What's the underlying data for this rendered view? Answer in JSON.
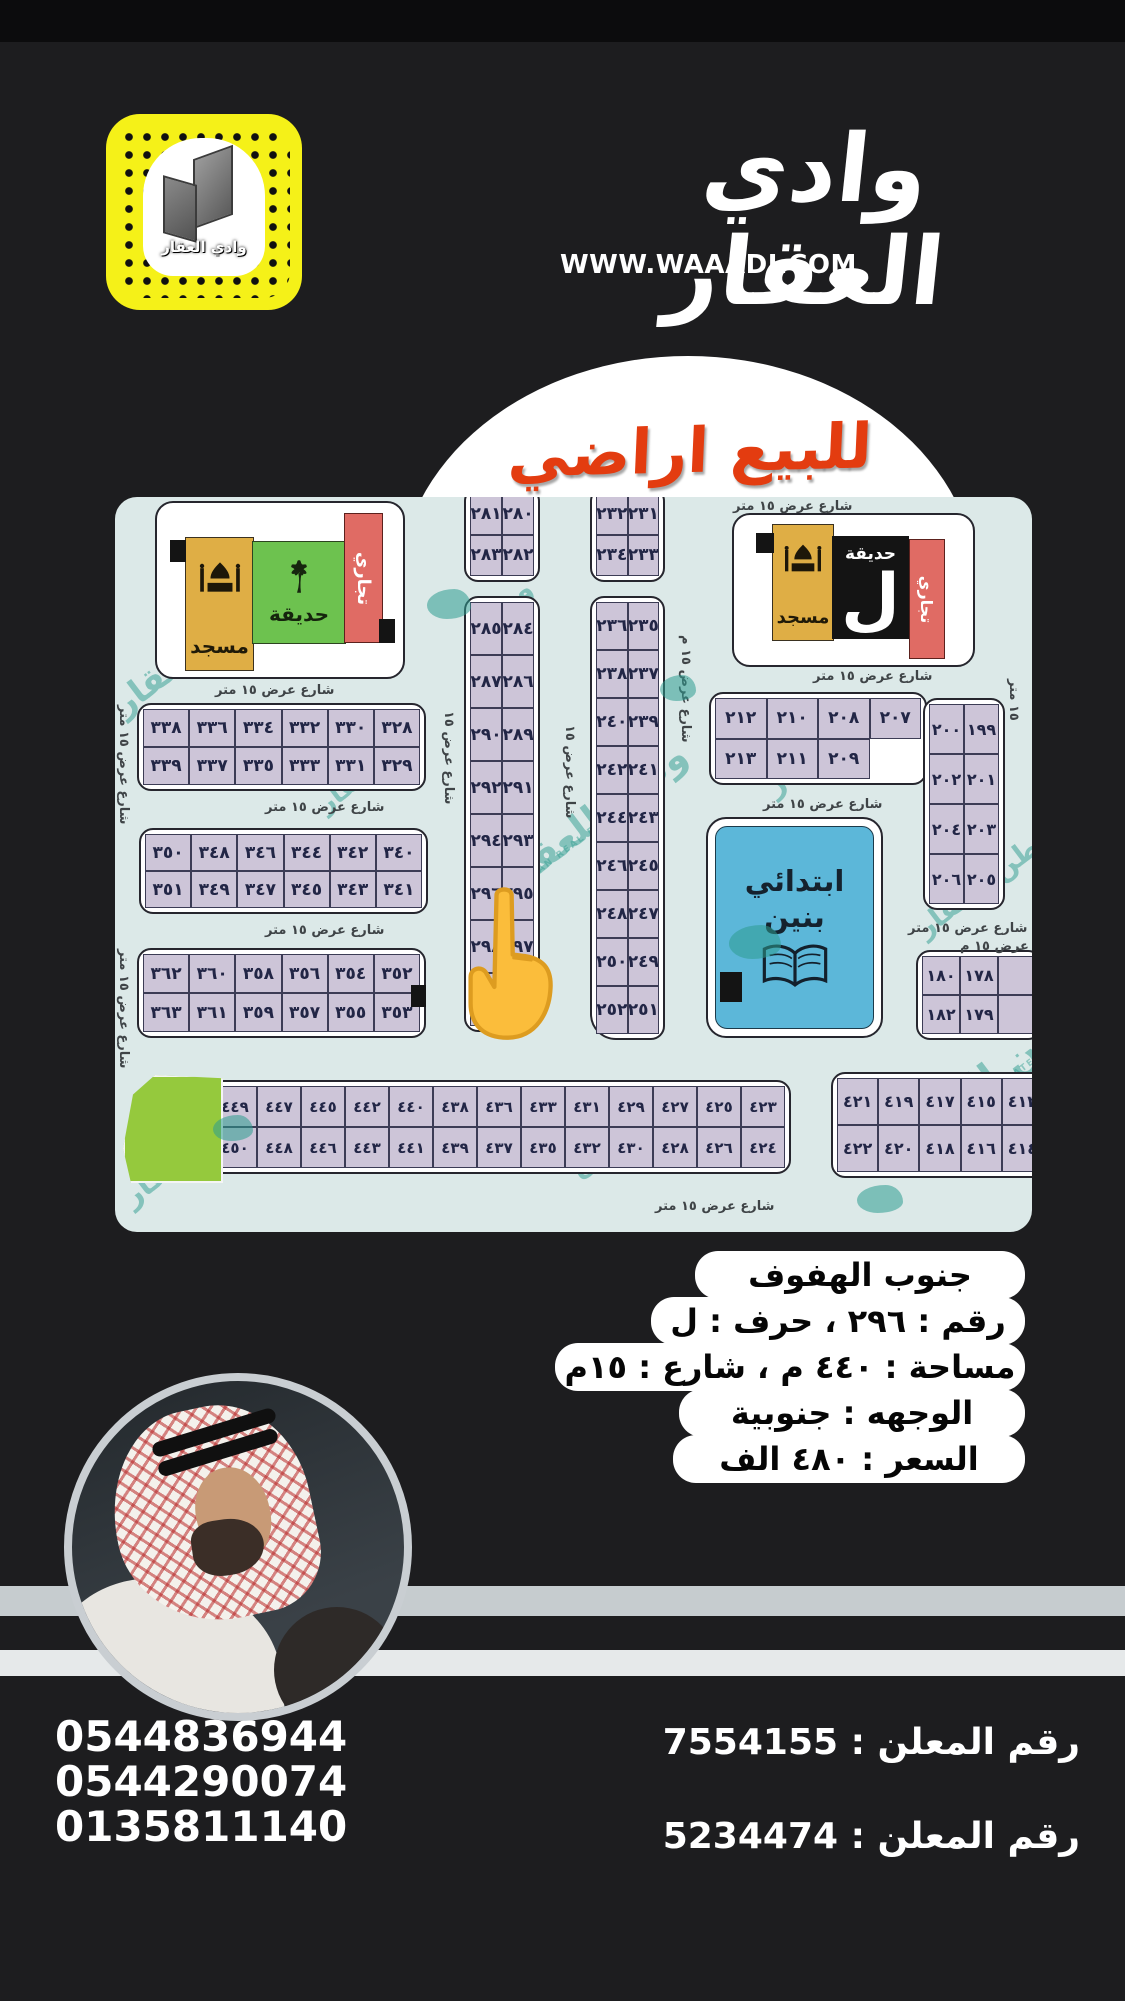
{
  "brand": {
    "name_ar": "وادي العقار",
    "website": "WWW.WAAADI.COM",
    "snapcode_caption": "وادي العقار"
  },
  "banner": {
    "title": "للبيع اراضي"
  },
  "map": {
    "facility": {
      "mosque": "مسجد",
      "garden": "حديقة",
      "commercial": "تجاري",
      "district_letter": "ل"
    },
    "school": {
      "line1": "ابتدائي",
      "line2": "بنين"
    },
    "plots": {
      "col_a_top": [
        [
          "٢٨١",
          "٢٨٠"
        ],
        [
          "٢٨٣",
          "٢٨٢"
        ]
      ],
      "col_a_main": [
        [
          "٢٨٥",
          "٢٨٤"
        ],
        [
          "٢٨٧",
          "٢٨٦"
        ],
        [
          "٢٩٠",
          "٢٨٩"
        ],
        [
          "٢٩٢",
          "٢٩١"
        ],
        [
          "٢٩٤",
          "٢٩٣"
        ],
        [
          "٢٩٦",
          "٢٩٥"
        ],
        [
          "٢٩٨",
          "٢٩٧"
        ],
        [
          "٣٠٠",
          "٢٩٩"
        ]
      ],
      "col_b_top": [
        [
          "٢٣٢",
          "٢٣١"
        ],
        [
          "٢٣٤",
          "٢٣٣"
        ]
      ],
      "col_b_main": [
        [
          "٢٣٦",
          "٢٣٥"
        ],
        [
          "٢٣٨",
          "٢٣٧"
        ],
        [
          "٢٤٠",
          "٢٣٩"
        ],
        [
          "٢٤٢",
          "٢٤١"
        ],
        [
          "٢٤٤",
          "٢٤٣"
        ],
        [
          "٢٤٦",
          "٢٤٥"
        ],
        [
          "٢٤٨",
          "٢٤٧"
        ],
        [
          "٢٥٠",
          "٢٤٩"
        ],
        [
          "٢٥٢",
          "٢٥١"
        ]
      ],
      "west_block_1": [
        [
          "٣٣٨",
          "٣٣٦",
          "٣٣٤",
          "٣٣٢",
          "٣٣٠",
          "٣٢٨"
        ],
        [
          "٣٣٩",
          "٣٣٧",
          "٣٣٥",
          "٣٣٣",
          "٣٣١",
          "٣٢٩"
        ]
      ],
      "west_block_2": [
        [
          "٣٥٠",
          "٣٤٨",
          "٣٤٦",
          "٣٤٤",
          "٣٤٢",
          "٣٤٠"
        ],
        [
          "٣٥١",
          "٣٤٩",
          "٣٤٧",
          "٣٤٥",
          "٣٤٣",
          "٣٤١"
        ]
      ],
      "west_block_3": [
        [
          "٣٦٢",
          "٣٦٠",
          "٣٥٨",
          "٣٥٦",
          "٣٥٤",
          "٣٥٢"
        ],
        [
          "٣٦٣",
          "٣٦١",
          "٣٥٩",
          "٣٥٧",
          "٣٥٥",
          "٣٥٣"
        ]
      ],
      "east_block_207": [
        [
          "٢١٢",
          "٢١٠",
          "٢٠٨",
          "٢٠٧"
        ],
        [
          "٢١٣",
          "٢١١",
          "٢٠٩",
          ""
        ]
      ],
      "east_col_199": [
        [
          "٢٠٠",
          "١٩٩"
        ],
        [
          "٢٠٢",
          "٢٠١"
        ],
        [
          "٢٠٤",
          "٢٠٣"
        ],
        [
          "٢٠٦",
          "٢٠٥"
        ]
      ],
      "east_block_178": [
        [
          "١٨٠",
          "١٧٨",
          " "
        ],
        [
          "١٨٢",
          "١٧٩",
          " "
        ]
      ],
      "south_block_long": [
        [
          "٤٤٩",
          "٤٤٧",
          "٤٤٥",
          "٤٤٢",
          "٤٤٠",
          "٤٣٨",
          "٤٣٦",
          "٤٣٣",
          "٤٣١",
          "٤٢٩",
          "٤٢٧",
          "٤٢٥",
          "٤٢٣"
        ],
        [
          "٤٥٠",
          "٤٤٨",
          "٤٤٦",
          "٤٤٣",
          "٤٤١",
          "٤٣٩",
          "٤٣٧",
          "٤٣٥",
          "٤٣٢",
          "٤٣٠",
          "٤٢٨",
          "٤٢٦",
          "٤٢٤"
        ]
      ],
      "south_block_right": [
        [
          "٤٢١",
          "٤١٩",
          "٤١٧",
          "٤١٥",
          "٤١٣"
        ],
        [
          "٤٢٢",
          "٤٢٠",
          "٤١٨",
          "٤١٦",
          "٤١٤"
        ]
      ]
    },
    "street_labels": [
      {
        "t": "شارع عرض ١٥ متر",
        "x": 618,
        "y": 2,
        "r": 0
      },
      {
        "t": "شارع عرض ١٥ متر",
        "x": 100,
        "y": 186,
        "r": 0
      },
      {
        "t": "شارع عرض ١٥ متر",
        "x": 150,
        "y": 303,
        "r": 0
      },
      {
        "t": "شارع عرض ١٥ متر",
        "x": 150,
        "y": 426,
        "r": 0
      },
      {
        "t": "شارع عرض ١٥ متر",
        "x": 540,
        "y": 702,
        "r": 0
      },
      {
        "t": "شارع عرض ١٥ متر",
        "x": 698,
        "y": 172,
        "r": 0
      },
      {
        "t": "شارع عرض ١٥ متر",
        "x": 648,
        "y": 300,
        "r": 0
      },
      {
        "t": "شارع عرض ١٥ متر",
        "x": 793,
        "y": 424,
        "r": 0
      },
      {
        "t": "شارع عرض ١٥ م",
        "x": 845,
        "y": 442,
        "r": 0
      },
      {
        "t": "شارع عرض ١٥ متر",
        "x": 16,
        "y": 208,
        "r": 90
      },
      {
        "t": "شارع عرض ١٥ متر",
        "x": 16,
        "y": 452,
        "r": 90
      },
      {
        "t": "شارع عرض ١٥",
        "x": 341,
        "y": 214,
        "r": 90
      },
      {
        "t": "شارع عرض ١٥",
        "x": 462,
        "y": 228,
        "r": 90
      },
      {
        "t": "شارع عرض ١٥ م",
        "x": 578,
        "y": 138,
        "r": 90
      },
      {
        "t": "١٥ متر",
        "x": 906,
        "y": 182,
        "r": 90
      }
    ],
    "watermarks": [
      {
        "t": "وطن ل",
        "x": 45,
        "y": 40,
        "s": 42
      },
      {
        "t": "للعقار",
        "x": -8,
        "y": 160,
        "s": 34
      },
      {
        "t": "وطن",
        "x": 352,
        "y": 92,
        "s": 28
      },
      {
        "t": "العقار",
        "x": 198,
        "y": 272,
        "s": 26
      },
      {
        "t": "وطن للعقار",
        "x": 368,
        "y": 298,
        "s": 38
      },
      {
        "t": "WATAN REAL ESTATE",
        "x": 388,
        "y": 344,
        "s": 9,
        "en": 1
      },
      {
        "t": "العقار",
        "x": 645,
        "y": 248,
        "s": 30
      },
      {
        "t": "وطن للعقار",
        "x": 788,
        "y": 368,
        "s": 28
      },
      {
        "t": "وطن للعقار",
        "x": 760,
        "y": 556,
        "s": 40
      },
      {
        "t": "WATAN REAL ESTATE",
        "x": 795,
        "y": 600,
        "s": 9,
        "en": 1
      },
      {
        "t": "للعقار",
        "x": 2,
        "y": 658,
        "s": 30
      },
      {
        "t": "وطن",
        "x": 452,
        "y": 640,
        "s": 26
      }
    ]
  },
  "listing": {
    "lines": [
      "جنوب الهفوف",
      "رقم : ٢٩٦ ، حرف : ل",
      "مساحة : ٤٤٠ م ، شارع : ١٥م",
      "الوجهه : جنوبية",
      "السعر : ٤٨٠ الف"
    ]
  },
  "contact": {
    "phones": [
      "0544836944",
      "0544290074",
      "0135811140"
    ],
    "advertiser": [
      {
        "label": "رقم المعلن :",
        "number": "7554155"
      },
      {
        "label": "رقم المعلن :",
        "number": "5234474"
      }
    ]
  },
  "colors": {
    "snap_yellow": "#f5f118",
    "title_red": "#e33c10",
    "map_bg": "#dce9e8",
    "plot_fill": "#cdc5d8",
    "mosque_gold": "#dfae45",
    "garden_green": "#6dc24f",
    "commercial_red": "#e06b64",
    "school_blue": "#5cb7d9",
    "watermark_teal": "#2e9d8f",
    "corner_green": "#95c93d"
  }
}
